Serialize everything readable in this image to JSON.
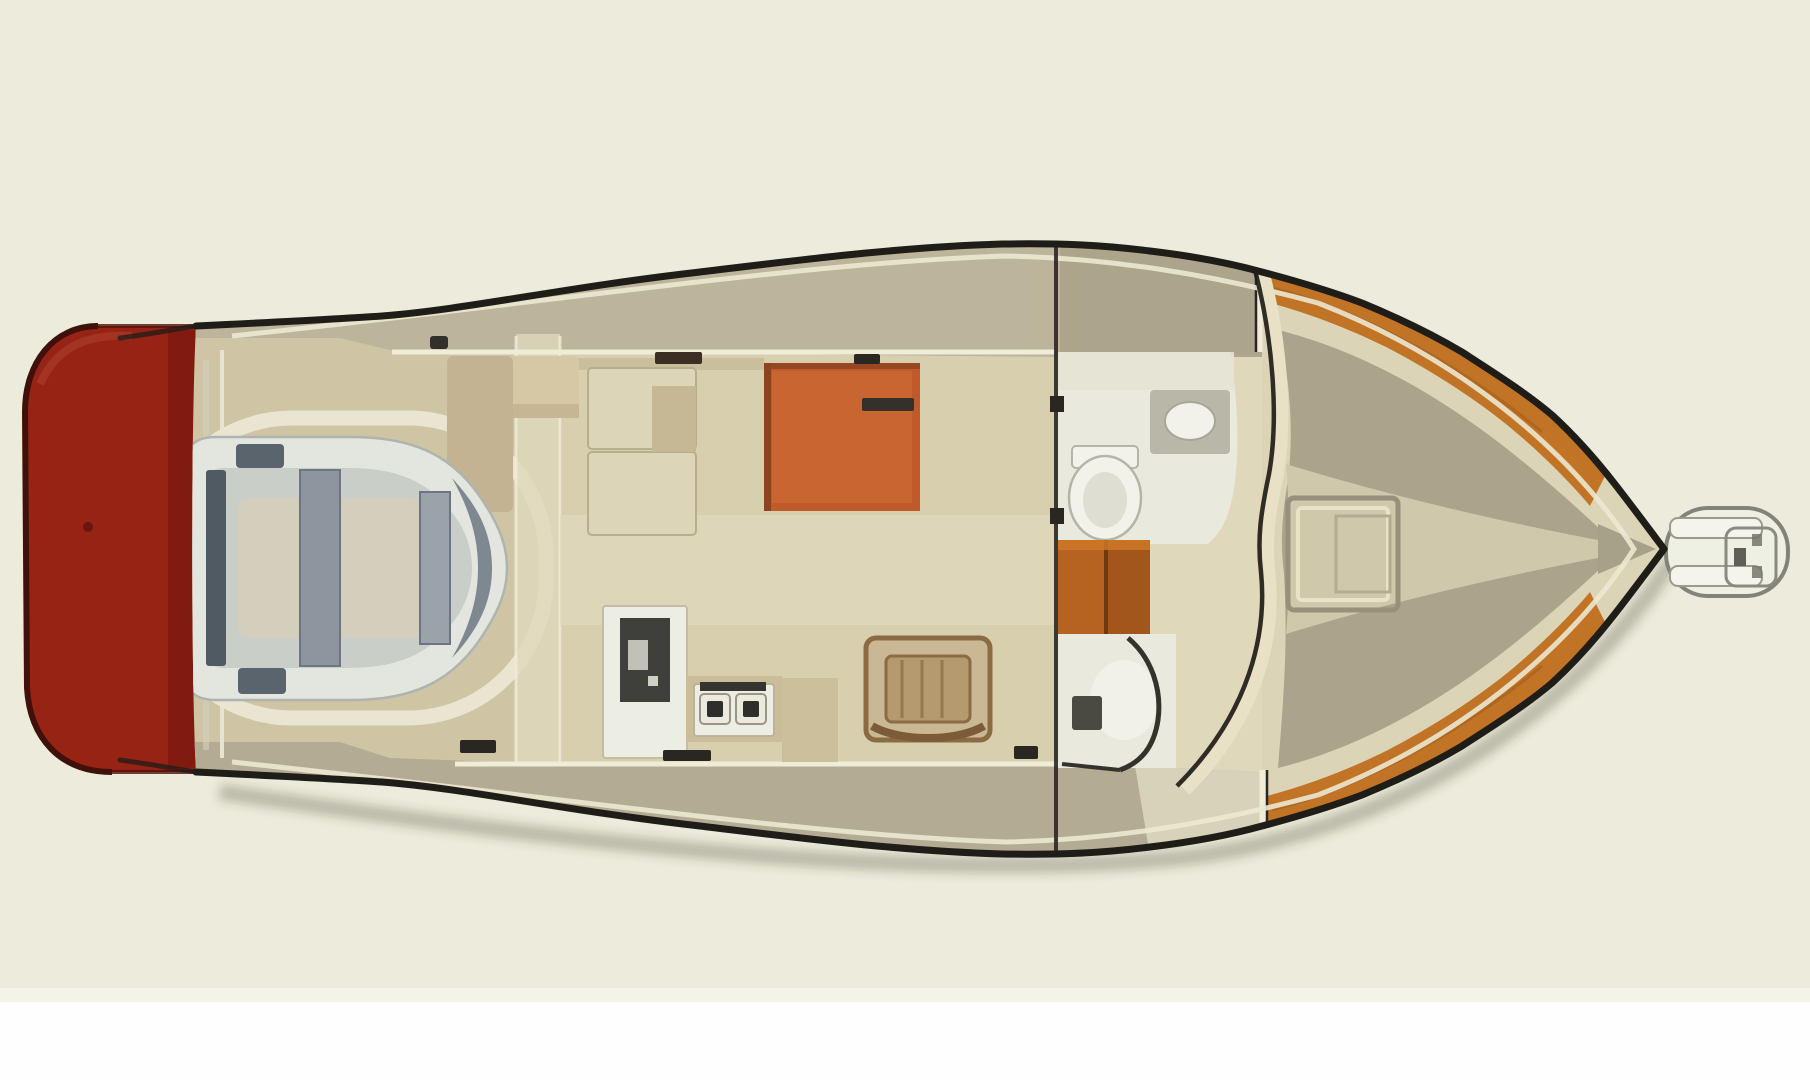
{
  "meta": {
    "description": "Top-down illustrated floor plan of a motor yacht: red swim platform astern (left), cockpit with stowed inflatable dinghy, salon with settee and orange dinette table, galley with sink unit and two-burner stove, wooden chair, head with toilet and sink, companionway steps, shower, teak-trimmed foredeck with deck hatch, bow pulpit with anchor roller (right)."
  },
  "colors": {
    "background": "#ecebdc",
    "bottom_strip": "#fefefe",
    "bottom_strip_edge": "#f4f3e8",
    "outline": "#1f1d18",
    "hull_fill": "#eff0e3",
    "shadow": "rgba(60,54,38,0.28)",
    "swim_platform": "#972315",
    "swim_platform_dark": "#7c1a0f",
    "swim_platform_edge": "#40100a",
    "swim_platform_highlight": "#b04432",
    "deck_top": "#bcb49b",
    "deck_top_fwd": "#aaa289",
    "deck_bottom": "#b3ab93",
    "deck_bottom_fwd": "#ddd8c1",
    "cockpit_sole": "#cfc5a5",
    "coaming": "#e9e5d0",
    "cabin_floor": "#d8cfae",
    "walkway": "#e0d8bb",
    "teak": "#c27426",
    "teak_dark": "#9c5718",
    "foredeck_base": "#dbd4b6",
    "foredeck_field": "#aba38b",
    "foredeck_path": "#cfc8ab",
    "tip_wedge": "#a8a18a",
    "hatch_frame": "#97917b",
    "hatch_inner": "#e8e2c8",
    "hatch_inner2": "#b3ac92",
    "bulwark_line": "#ece8d2",
    "cabin_line": "#efecd8",
    "windshield": "#e8e1c6",
    "settee": "#dcd5b8",
    "settee_edge": "#b9ae8c",
    "settee_inset": "#c6b894",
    "bench": "#c3b392",
    "bench_top": "#d6c8a4",
    "table": "#bf5b2b",
    "table_light": "#cf6e36",
    "table_edge": "#8d4220",
    "galley_unit": "#edeee3",
    "galley_panel": "#3f403c",
    "counter": "#cbbd9a",
    "burner": "#2e2e2a",
    "burner_plate": "#eceade",
    "chair_wood": "#8a6b43",
    "chair_fill": "#c9b893",
    "chair_seat": "#b49a6e",
    "chair_back": "#7c5c38",
    "head_fill": "#e9e9dd",
    "head_roof": "#e6e4d4",
    "fixture_white": "#f2f2ea",
    "fixture_rim": "#b5b5a7",
    "fixture_inner": "#dedfd2",
    "sink_counter": "#b9b7a8",
    "steps_wood": "#b66221",
    "steps_divider": "#6e3a12",
    "steps_shade": "#8a4a16",
    "steps_highlight": "#d07b28",
    "shower_fixture": "#4a4a42",
    "shower_wall": "#35322b",
    "dark_mark": "#2a2722",
    "handrail": "#3a2f22",
    "transom_streak": "#d2cfbd",
    "dinghy_tube": "#e3e5df",
    "dinghy_tube_shade": "#aeb4ae",
    "dinghy_interior": "#c9cec9",
    "dinghy_floor": "#d4cfba",
    "dinghy_dark": "#4f5a62",
    "dinghy_thwart": "#8d969e",
    "dinghy_bow": "#7d8890",
    "pulpit_fill": "#eff0e4",
    "pulpit_stroke": "#83837a",
    "pulpit_rail": "#f4f4ea",
    "pulpit_detail": "#5f5f55"
  }
}
